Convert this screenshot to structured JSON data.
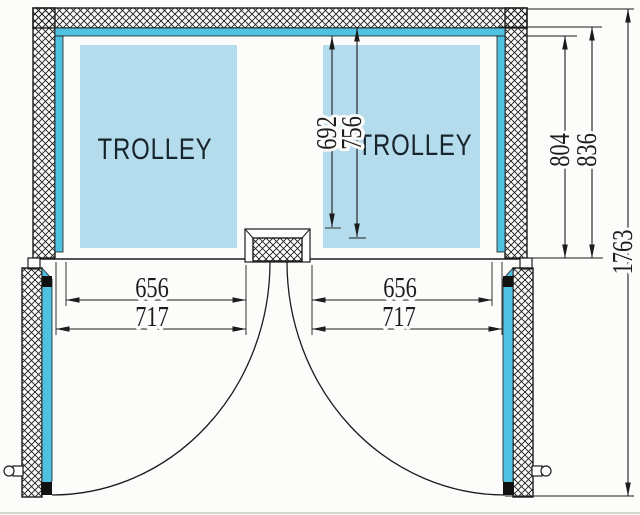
{
  "colors": {
    "bg": "#fcfcfa",
    "line": "#1c1c1c",
    "lining": "#4fc1e1",
    "trolley": "#b4dcec",
    "text": "#17242c"
  },
  "trolleys": {
    "left_label": "TROLLEY",
    "right_label": "TROLLEY"
  },
  "dimensions": {
    "left_clear_width": "656",
    "left_opening_width": "717",
    "right_clear_width": "656",
    "right_opening_width": "717",
    "trolley_depth": "692",
    "clear_depth_to_post": "756",
    "interior_depth": "804",
    "lining_depth": "836",
    "overall_depth": "1763"
  }
}
